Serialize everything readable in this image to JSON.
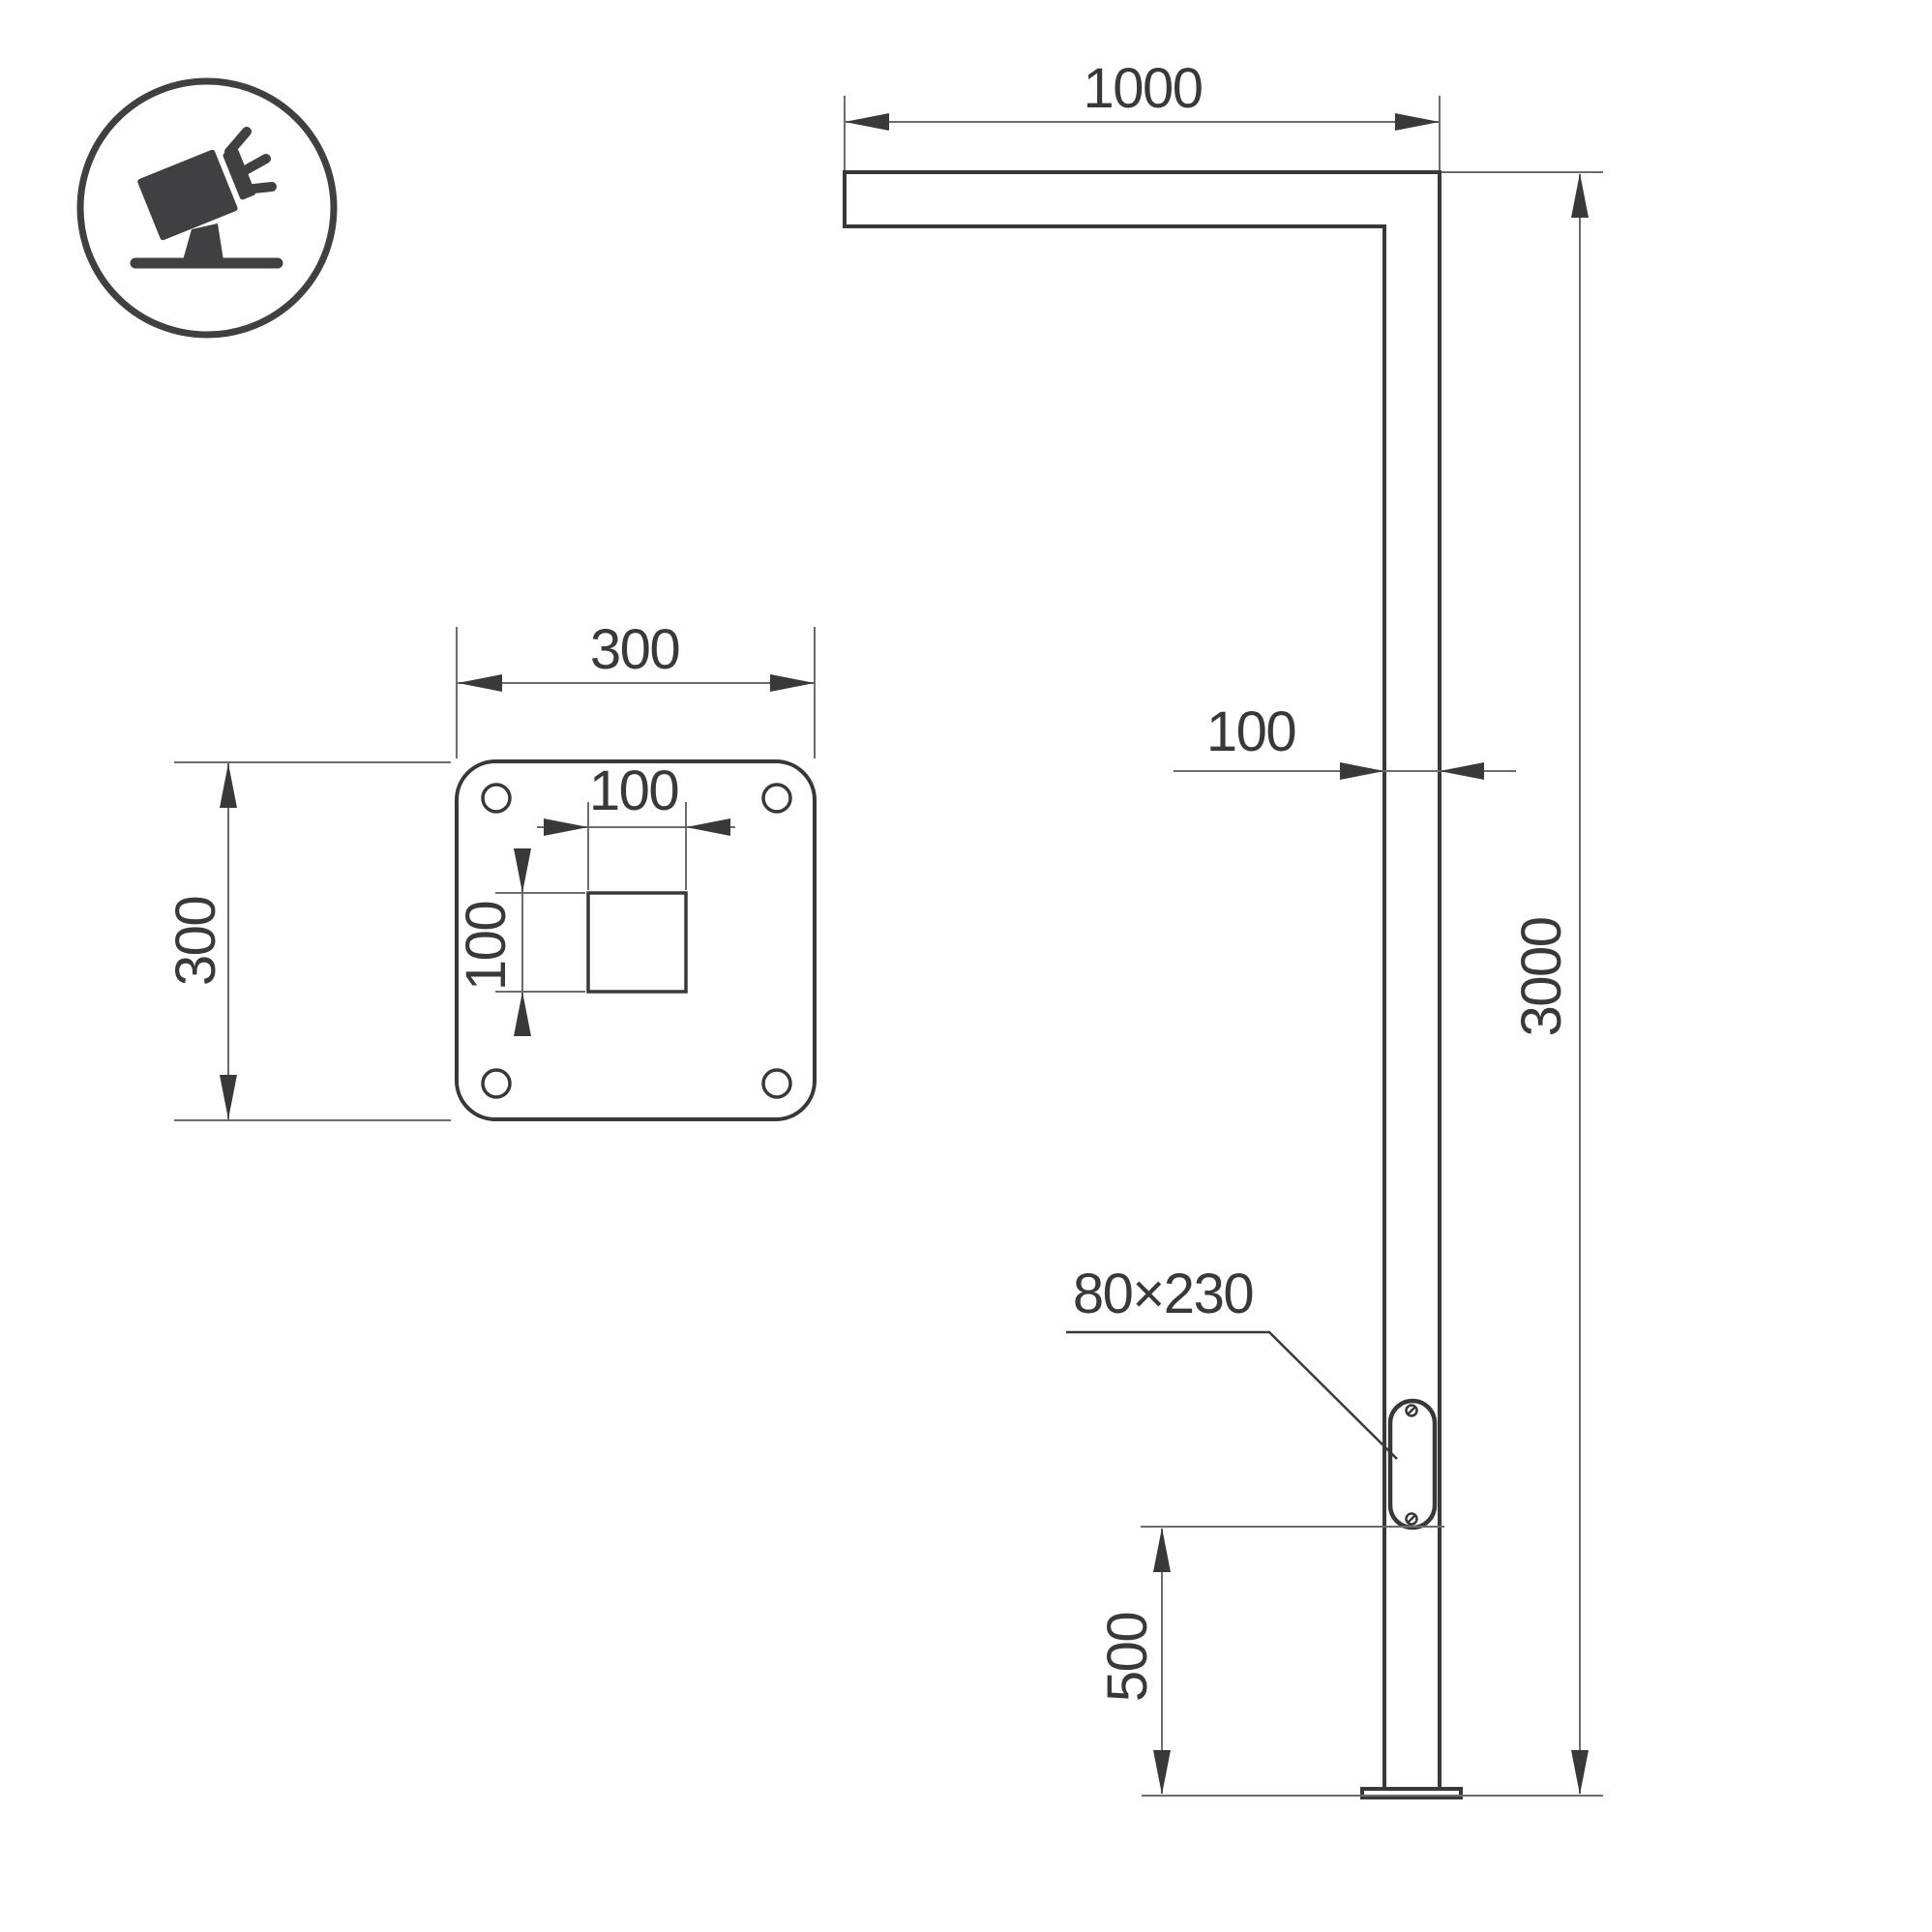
{
  "drawing": {
    "title": "street-light-pole-dimension-drawing",
    "background": "#ffffff",
    "object_line_color": "#38383a",
    "dimension_line_color": "#6c6c6e",
    "text_color": "#39393b",
    "icon": "tilted-floodlight",
    "labels": {
      "arm_length": "1000",
      "pole_width": "100",
      "pole_height": "3000",
      "hatch_size": "80×230",
      "hatch_height": "500",
      "plate_width": "300",
      "plate_side": "300",
      "square_width": "100",
      "square_height": "100"
    }
  }
}
